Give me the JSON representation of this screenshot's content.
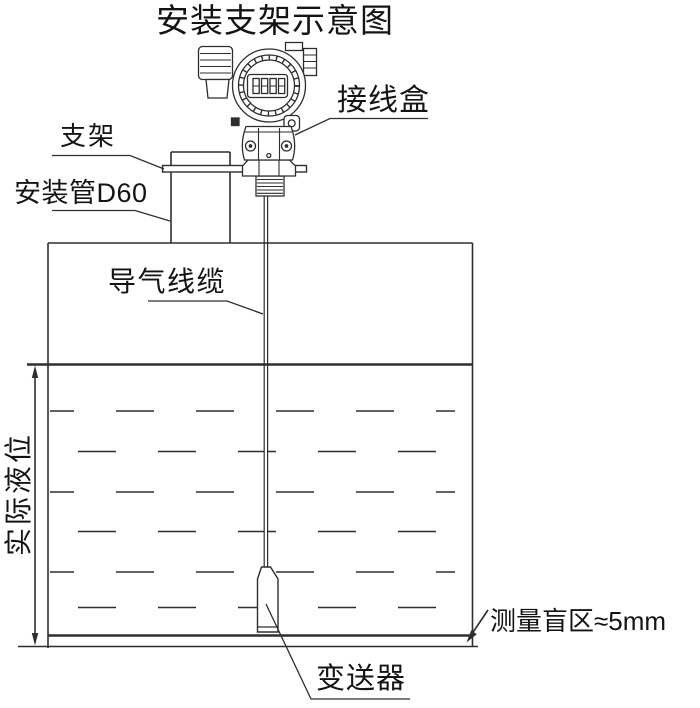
{
  "title": "安装支架示意图",
  "diagram_type": "installation-bracket-schematic",
  "labels": {
    "junction_box": "接线盒",
    "bracket": "支架",
    "mounting_pipe": "安装管D60",
    "air_cable": "导气线缆",
    "actual_level": "实际液位",
    "blind_zone": "测量盲区≈5mm",
    "transmitter": "变送器"
  },
  "icons": {
    "transmitter_head": "round-housing-with-lcd",
    "lcd_display": "8888-segment-digits",
    "cable_gland": "ribbed-gland",
    "hex_nut": "hex-nut",
    "dimension_arrow": "double-headed-vertical-arrow",
    "blind_zone_arrow": "leader-arrow"
  },
  "colors": {
    "background": "#ffffff",
    "line": "#2e2e2e",
    "text": "#141414"
  }
}
